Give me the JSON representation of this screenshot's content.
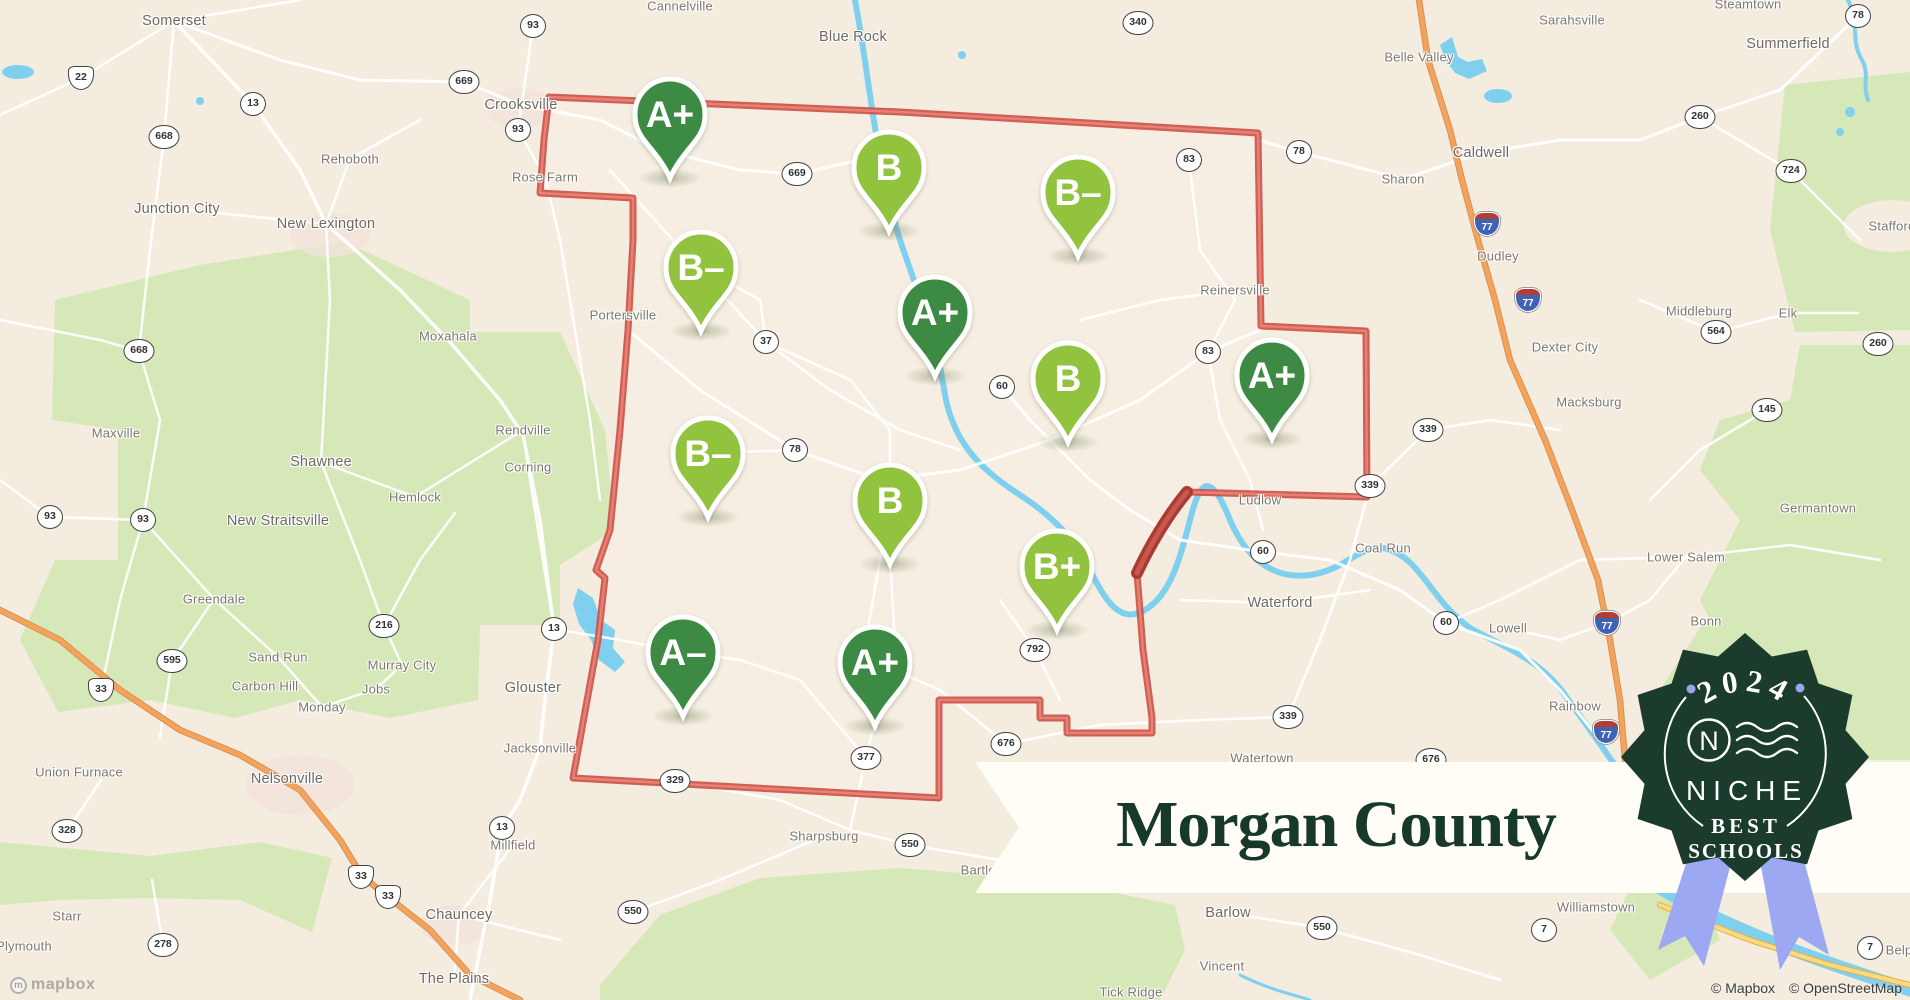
{
  "map": {
    "background_color": "#f3ecdf",
    "boundary_color": "#cd4f44",
    "marker_colors": {
      "dark": "#3c8a43",
      "light": "#92c33e"
    },
    "markers": [
      {
        "grade": "A+",
        "tone": "dark",
        "x": 670,
        "y": 114
      },
      {
        "grade": "B",
        "tone": "light",
        "x": 889,
        "y": 167
      },
      {
        "grade": "B-",
        "tone": "light",
        "x": 1078,
        "y": 192
      },
      {
        "grade": "B-",
        "tone": "light",
        "x": 701,
        "y": 267
      },
      {
        "grade": "A+",
        "tone": "dark",
        "x": 935,
        "y": 312
      },
      {
        "grade": "B",
        "tone": "light",
        "x": 1068,
        "y": 378
      },
      {
        "grade": "A+",
        "tone": "dark",
        "x": 1272,
        "y": 375
      },
      {
        "grade": "B-",
        "tone": "light",
        "x": 708,
        "y": 453
      },
      {
        "grade": "B",
        "tone": "light",
        "x": 890,
        "y": 500
      },
      {
        "grade": "B+",
        "tone": "light",
        "x": 1057,
        "y": 566
      },
      {
        "grade": "A-",
        "tone": "dark",
        "x": 683,
        "y": 652
      },
      {
        "grade": "A+",
        "tone": "dark",
        "x": 875,
        "y": 662
      }
    ],
    "labels": [
      {
        "text": "Somerset",
        "x": 174,
        "y": 21,
        "size": "md"
      },
      {
        "text": "Cannelville",
        "x": 680,
        "y": 6,
        "size": "sm"
      },
      {
        "text": "Blue Rock",
        "x": 853,
        "y": 37,
        "size": "md"
      },
      {
        "text": "Belle Valley",
        "x": 1419,
        "y": 57,
        "size": "sm"
      },
      {
        "text": "Sarahsville",
        "x": 1572,
        "y": 20,
        "size": "sm"
      },
      {
        "text": "Steamtown",
        "x": 1748,
        "y": 4,
        "size": "sm"
      },
      {
        "text": "Summerfield",
        "x": 1788,
        "y": 44,
        "size": "md"
      },
      {
        "text": "Stafford",
        "x": 1892,
        "y": 226,
        "size": "sm"
      },
      {
        "text": "Crooksville",
        "x": 521,
        "y": 105,
        "size": "md"
      },
      {
        "text": "Rehoboth",
        "x": 350,
        "y": 159,
        "size": "sm"
      },
      {
        "text": "Rose Farm",
        "x": 545,
        "y": 177,
        "size": "sm"
      },
      {
        "text": "Caldwell",
        "x": 1481,
        "y": 153,
        "size": "md"
      },
      {
        "text": "Sharon",
        "x": 1403,
        "y": 179,
        "size": "sm"
      },
      {
        "text": "Junction City",
        "x": 177,
        "y": 209,
        "size": "md"
      },
      {
        "text": "New Lexington",
        "x": 326,
        "y": 224,
        "size": "md"
      },
      {
        "text": "Dudley",
        "x": 1498,
        "y": 256,
        "size": "sm"
      },
      {
        "text": "Middleburg",
        "x": 1699,
        "y": 311,
        "size": "sm"
      },
      {
        "text": "Elk",
        "x": 1788,
        "y": 313,
        "size": "sm"
      },
      {
        "text": "Dexter City",
        "x": 1565,
        "y": 347,
        "size": "sm"
      },
      {
        "text": "Moxahala",
        "x": 448,
        "y": 336,
        "size": "sm"
      },
      {
        "text": "Maxville",
        "x": 116,
        "y": 433,
        "size": "sm"
      },
      {
        "text": "Macksburg",
        "x": 1589,
        "y": 402,
        "size": "sm"
      },
      {
        "text": "Rendville",
        "x": 523,
        "y": 430,
        "size": "sm"
      },
      {
        "text": "Corning",
        "x": 528,
        "y": 467,
        "size": "sm"
      },
      {
        "text": "Shawnee",
        "x": 321,
        "y": 462,
        "size": "md"
      },
      {
        "text": "Hemlock",
        "x": 415,
        "y": 497,
        "size": "sm"
      },
      {
        "text": "New Straitsville",
        "x": 278,
        "y": 521,
        "size": "md"
      },
      {
        "text": "Reinersville",
        "x": 1235,
        "y": 290,
        "size": "sm"
      },
      {
        "text": "Portersville",
        "x": 623,
        "y": 315,
        "size": "sm"
      },
      {
        "text": "Germantown",
        "x": 1818,
        "y": 508,
        "size": "sm"
      },
      {
        "text": "Lower Salem",
        "x": 1686,
        "y": 557,
        "size": "sm"
      },
      {
        "text": "Ludlow",
        "x": 1260,
        "y": 500,
        "size": "sm"
      },
      {
        "text": "Coal Run",
        "x": 1383,
        "y": 548,
        "size": "sm"
      },
      {
        "text": "Waterford",
        "x": 1280,
        "y": 603,
        "size": "md"
      },
      {
        "text": "Lowell",
        "x": 1508,
        "y": 628,
        "size": "sm"
      },
      {
        "text": "Bonn",
        "x": 1706,
        "y": 621,
        "size": "sm"
      },
      {
        "text": "Greendale",
        "x": 214,
        "y": 599,
        "size": "sm"
      },
      {
        "text": "Sand Run",
        "x": 278,
        "y": 657,
        "size": "sm"
      },
      {
        "text": "Murray City",
        "x": 402,
        "y": 665,
        "size": "sm"
      },
      {
        "text": "Carbon Hill",
        "x": 265,
        "y": 686,
        "size": "sm"
      },
      {
        "text": "Jobs",
        "x": 376,
        "y": 689,
        "size": "sm"
      },
      {
        "text": "Monday",
        "x": 322,
        "y": 707,
        "size": "sm"
      },
      {
        "text": "Union Furnace",
        "x": 79,
        "y": 772,
        "size": "sm"
      },
      {
        "text": "Nelsonville",
        "x": 287,
        "y": 779,
        "size": "md"
      },
      {
        "text": "Glouster",
        "x": 533,
        "y": 688,
        "size": "md"
      },
      {
        "text": "Jacksonville",
        "x": 540,
        "y": 748,
        "size": "sm"
      },
      {
        "text": "Millfield",
        "x": 513,
        "y": 845,
        "size": "sm"
      },
      {
        "text": "Sharpsburg",
        "x": 824,
        "y": 836,
        "size": "sm"
      },
      {
        "text": "Bartlett",
        "x": 982,
        "y": 870,
        "size": "sm"
      },
      {
        "text": "Watertown",
        "x": 1262,
        "y": 758,
        "size": "sm"
      },
      {
        "text": "Rainbow",
        "x": 1575,
        "y": 706,
        "size": "sm"
      },
      {
        "text": "Williamstown",
        "x": 1596,
        "y": 907,
        "size": "sm"
      },
      {
        "text": "Starr",
        "x": 67,
        "y": 916,
        "size": "sm"
      },
      {
        "text": "Plymouth",
        "x": 24,
        "y": 946,
        "size": "sm"
      },
      {
        "text": "Chauncey",
        "x": 459,
        "y": 915,
        "size": "md"
      },
      {
        "text": "The Plains",
        "x": 454,
        "y": 979,
        "size": "md"
      },
      {
        "text": "Barlow",
        "x": 1228,
        "y": 913,
        "size": "md"
      },
      {
        "text": "Vincent",
        "x": 1222,
        "y": 966,
        "size": "sm"
      },
      {
        "text": "Tick Ridge",
        "x": 1131,
        "y": 992,
        "size": "sm"
      },
      {
        "text": "Belpre",
        "x": 1905,
        "y": 950,
        "size": "sm"
      }
    ],
    "shields": [
      {
        "num": "93",
        "kind": "state",
        "x": 533,
        "y": 26
      },
      {
        "num": "93",
        "kind": "state",
        "x": 518,
        "y": 130
      },
      {
        "num": "93",
        "kind": "state",
        "x": 50,
        "y": 517
      },
      {
        "num": "93",
        "kind": "state",
        "x": 143,
        "y": 520
      },
      {
        "num": "13",
        "kind": "state",
        "x": 253,
        "y": 104
      },
      {
        "num": "13",
        "kind": "state",
        "x": 554,
        "y": 629
      },
      {
        "num": "13",
        "kind": "state",
        "x": 502,
        "y": 828
      },
      {
        "num": "668",
        "kind": "state",
        "x": 164,
        "y": 137
      },
      {
        "num": "668",
        "kind": "state",
        "x": 139,
        "y": 351
      },
      {
        "num": "669",
        "kind": "state",
        "x": 464,
        "y": 82
      },
      {
        "num": "669",
        "kind": "state",
        "x": 797,
        "y": 174
      },
      {
        "num": "340",
        "kind": "state",
        "x": 1138,
        "y": 23
      },
      {
        "num": "83",
        "kind": "state",
        "x": 1189,
        "y": 160
      },
      {
        "num": "83",
        "kind": "state",
        "x": 1208,
        "y": 352
      },
      {
        "num": "78",
        "kind": "state",
        "x": 1299,
        "y": 152
      },
      {
        "num": "78",
        "kind": "state",
        "x": 795,
        "y": 450
      },
      {
        "num": "78",
        "kind": "state",
        "x": 1858,
        "y": 16
      },
      {
        "num": "37",
        "kind": "state",
        "x": 766,
        "y": 342
      },
      {
        "num": "60",
        "kind": "state",
        "x": 1002,
        "y": 387
      },
      {
        "num": "60",
        "kind": "state",
        "x": 1263,
        "y": 552
      },
      {
        "num": "60",
        "kind": "state",
        "x": 1446,
        "y": 623
      },
      {
        "num": "339",
        "kind": "state",
        "x": 1428,
        "y": 430
      },
      {
        "num": "339",
        "kind": "state",
        "x": 1370,
        "y": 486
      },
      {
        "num": "339",
        "kind": "state",
        "x": 1288,
        "y": 717
      },
      {
        "num": "792",
        "kind": "state",
        "x": 1035,
        "y": 650
      },
      {
        "num": "377",
        "kind": "state",
        "x": 866,
        "y": 758
      },
      {
        "num": "329",
        "kind": "state",
        "x": 675,
        "y": 781
      },
      {
        "num": "676",
        "kind": "state",
        "x": 1006,
        "y": 744
      },
      {
        "num": "676",
        "kind": "state",
        "x": 1431,
        "y": 760
      },
      {
        "num": "550",
        "kind": "state",
        "x": 910,
        "y": 845
      },
      {
        "num": "550",
        "kind": "state",
        "x": 633,
        "y": 912
      },
      {
        "num": "550",
        "kind": "state",
        "x": 1322,
        "y": 928
      },
      {
        "num": "216",
        "kind": "state",
        "x": 384,
        "y": 626
      },
      {
        "num": "595",
        "kind": "state",
        "x": 172,
        "y": 661
      },
      {
        "num": "328",
        "kind": "state",
        "x": 67,
        "y": 831
      },
      {
        "num": "278",
        "kind": "state",
        "x": 163,
        "y": 945
      },
      {
        "num": "724",
        "kind": "state",
        "x": 1791,
        "y": 171
      },
      {
        "num": "260",
        "kind": "state",
        "x": 1700,
        "y": 117
      },
      {
        "num": "260",
        "kind": "state",
        "x": 1878,
        "y": 344
      },
      {
        "num": "564",
        "kind": "state",
        "x": 1716,
        "y": 332
      },
      {
        "num": "145",
        "kind": "state",
        "x": 1767,
        "y": 410
      },
      {
        "num": "7",
        "kind": "state",
        "x": 1544,
        "y": 930
      },
      {
        "num": "7",
        "kind": "state",
        "x": 1870,
        "y": 948
      },
      {
        "num": "22",
        "kind": "us",
        "x": 81,
        "y": 78
      },
      {
        "num": "33",
        "kind": "us",
        "x": 101,
        "y": 690
      },
      {
        "num": "33",
        "kind": "us",
        "x": 361,
        "y": 877
      },
      {
        "num": "33",
        "kind": "us",
        "x": 388,
        "y": 897
      },
      {
        "num": "77",
        "kind": "i",
        "x": 1487,
        "y": 224
      },
      {
        "num": "77",
        "kind": "i",
        "x": 1528,
        "y": 300
      },
      {
        "num": "77",
        "kind": "i",
        "x": 1607,
        "y": 623
      },
      {
        "num": "77",
        "kind": "i",
        "x": 1606,
        "y": 732
      }
    ]
  },
  "banner": {
    "title": "Morgan County",
    "text_color": "#17392a"
  },
  "badge": {
    "year": "2024",
    "brand": "NICHE",
    "award_line1": "BEST",
    "award_line2": "SCHOOLS",
    "bg_color": "#1b3b2c",
    "ribbon_color": "#9ca9f2",
    "dot_color": "#96a5ef"
  },
  "attribution": {
    "logo_text": "mapbox",
    "mapbox": "© Mapbox",
    "osm": "© OpenStreetMap"
  }
}
